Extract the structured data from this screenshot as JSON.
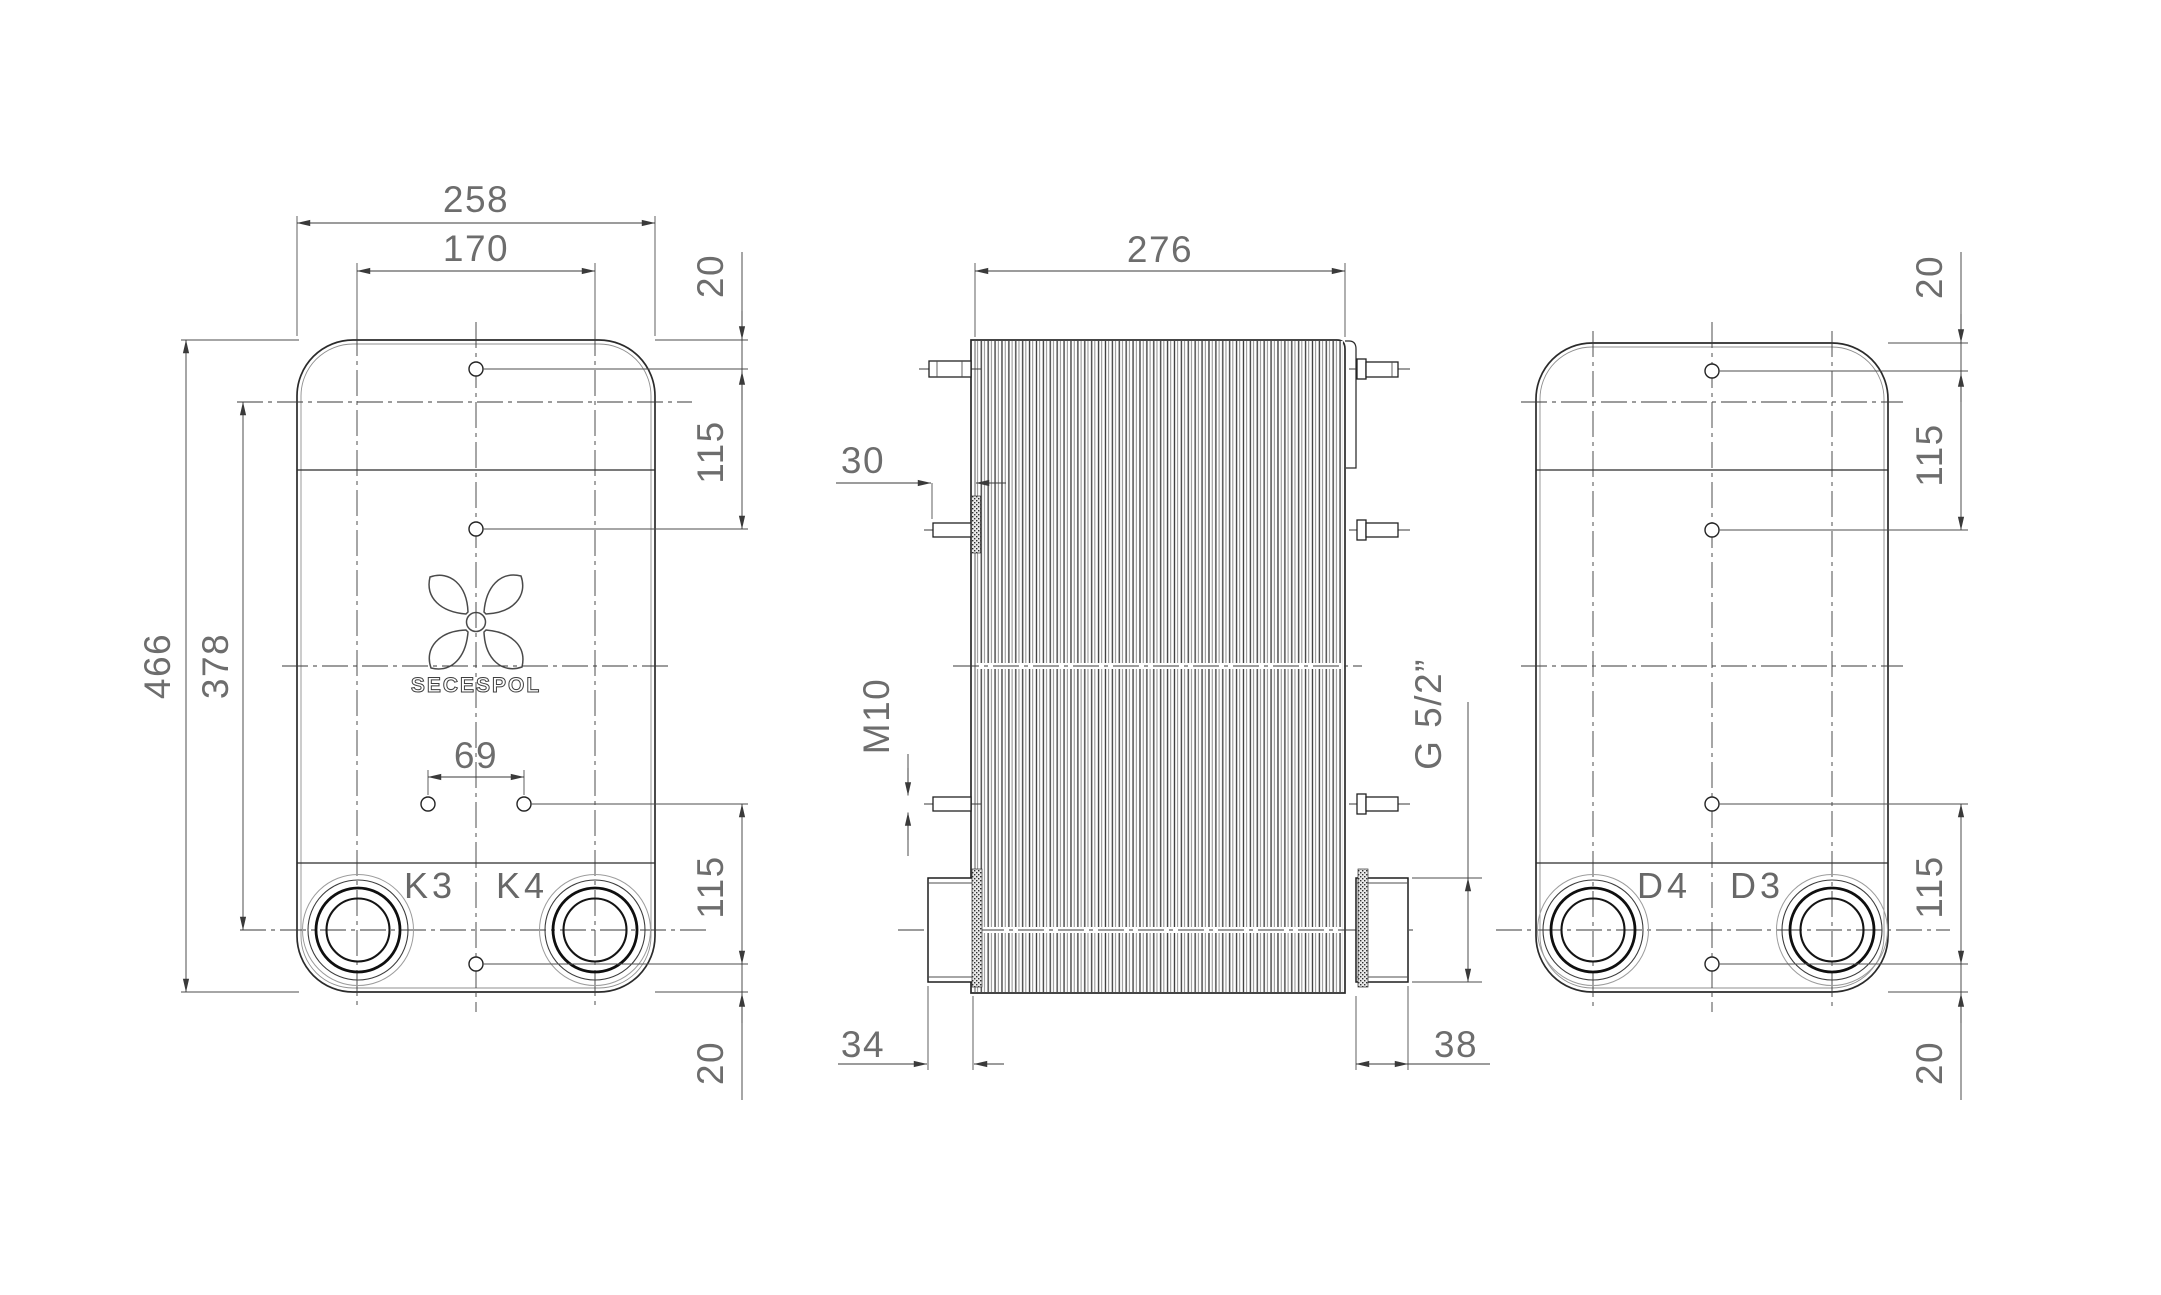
{
  "drawing": {
    "type": "engineering-dimension-drawing",
    "logo_text": "SECESPOL",
    "colors": {
      "line": "#2b2b2b",
      "dim_text": "#6d6d6d",
      "background": "#ffffff"
    },
    "views": {
      "front": {
        "ports": {
          "left_label": "K3",
          "right_label": "K4"
        },
        "dims": {
          "overall_width": "258",
          "hole_span": "170",
          "top_hole_offset": "20",
          "upper_hole_pitch": "115",
          "overall_height": "466",
          "port_center_height": "378",
          "lower_hole_pair_span": "69",
          "lower_hole_pitch": "115",
          "bottom_hole_offset": "20"
        }
      },
      "side": {
        "dims": {
          "pack_length": "276",
          "stud_protrusion": "30",
          "stud_thread": "M10",
          "connection_thread": "G 5/2”",
          "front_nozzle_length": "34",
          "rear_nozzle_length": "38"
        }
      },
      "rear": {
        "ports": {
          "left_label": "D4",
          "right_label": "D3"
        },
        "dims": {
          "top_hole_offset": "20",
          "upper_hole_pitch": "115",
          "lower_hole_pitch": "115",
          "bottom_hole_offset": "20"
        }
      }
    }
  }
}
